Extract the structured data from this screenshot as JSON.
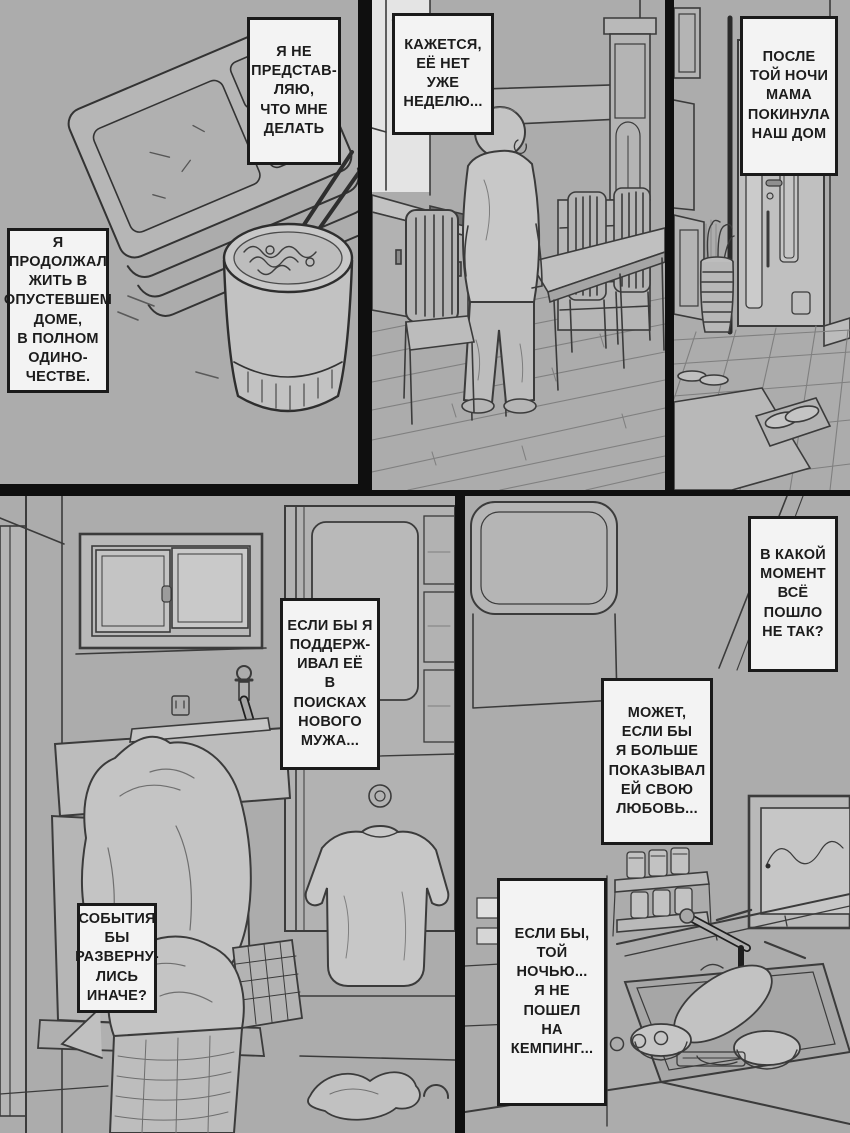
{
  "page": {
    "colors": {
      "background": "#acacac",
      "gutter": "#0f0f0f",
      "bubble_bg": "#f3f3f3",
      "bubble_border": "#1a1a1a",
      "text": "#1c1c1c",
      "line_art": "#3b3b3b"
    }
  },
  "bubbles": {
    "cant_imagine": {
      "text": "Я НЕ\nПРЕДСТАВ-\nЛЯЮ,\nЧТО МНЕ\nДЕЛАТЬ"
    },
    "lived_alone": {
      "text": "Я\nПРОДОЛЖАЛ\nЖИТЬ В\nОПУСТЕВШЕМ\nДОМЕ,\nВ ПОЛНОМ\nОДИНО-\nЧЕСТВЕ."
    },
    "gone_week": {
      "text": "КАЖЕТСЯ,\nЕЁ НЕТ\nУЖЕ\nНЕДЕЛЮ..."
    },
    "mom_left": {
      "text": "ПОСЛЕ\nТОЙ НОЧИ\nМАМА\nПОКИНУЛА\nНАШ ДОМ"
    },
    "supported_her": {
      "text": "ЕСЛИ БЫ Я\nПОДДЕРЖ-\nИВАЛ ЕЁ\nВ ПОИСКАХ\nНОВОГО\nМУЖА..."
    },
    "turned_out": {
      "text": "СОБЫТИЯ\nБЫ\nРАЗВЕРНУ-\nЛИСЬ\nИНАЧЕ?"
    },
    "what_moment": {
      "text": "В КАКОЙ\nМОМЕНТ\nВСЁ\nПОШЛО\nНЕ ТАК?"
    },
    "shown_love": {
      "text": "МОЖЕТ,\nЕСЛИ БЫ\nЯ БОЛЬШЕ\nПОКАЗЫВАЛ\nЕЙ СВОЮ\nЛЮБОВЬ..."
    },
    "not_camping": {
      "text": "ЕСЛИ БЫ,\nТОЙ НОЧЬЮ...\nЯ НЕ ПОШЕЛ\nНА\nКЕМПИНГ..."
    }
  }
}
